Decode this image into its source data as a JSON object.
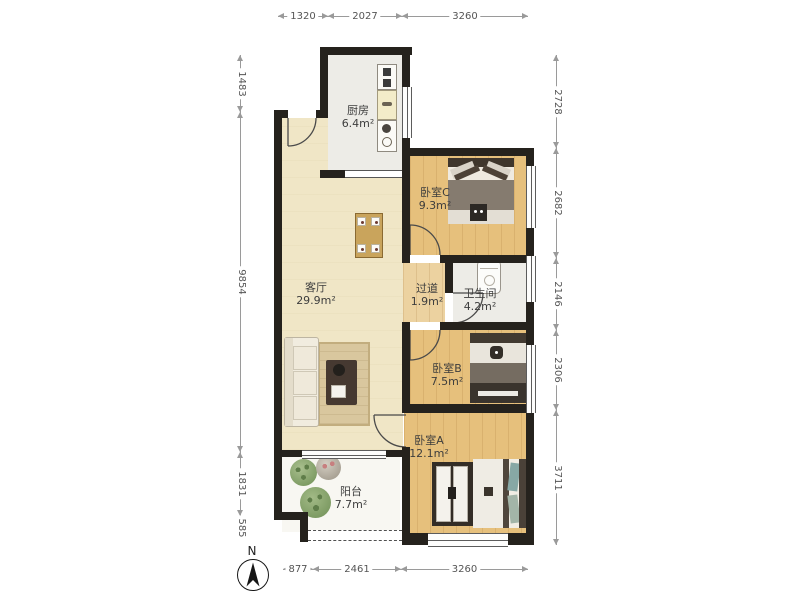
{
  "rooms": {
    "kitchen": {
      "name": "厨房",
      "area": "6.4m²"
    },
    "bedroomC": {
      "name": "卧室C",
      "area": "9.3m²"
    },
    "living": {
      "name": "客厅",
      "area": "29.9m²"
    },
    "hallway": {
      "name": "过道",
      "area": "1.9m²"
    },
    "bathroom": {
      "name": "卫生间",
      "area": "4.2m²"
    },
    "bedroomB": {
      "name": "卧室B",
      "area": "7.5m²"
    },
    "bedroomA": {
      "name": "卧室A",
      "area": "12.1m²"
    },
    "balcony": {
      "name": "阳台",
      "area": "7.7m²"
    }
  },
  "dimensions_mm": {
    "top": [
      "1320",
      "2027",
      "3260"
    ],
    "bottom": [
      "877",
      "2461",
      "3260"
    ],
    "left": [
      "1483",
      "9854",
      "1831",
      "585"
    ],
    "right": [
      "2728",
      "2682",
      "2146",
      "2306",
      "3711"
    ]
  },
  "compass": {
    "label": "N"
  },
  "colors": {
    "wall": "#25221d",
    "wood_floor": "#e6c07c",
    "living_floor": "#f0e6c6",
    "tile_floor": "#edece7",
    "balcony_floor": "#f8f7f2",
    "plant_green": "#7d9b63"
  }
}
